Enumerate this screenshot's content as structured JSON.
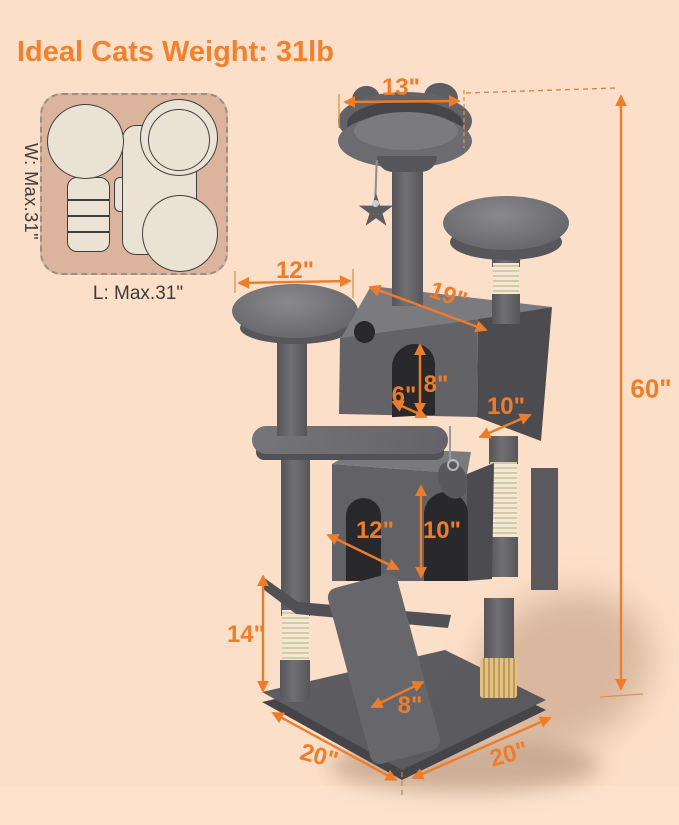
{
  "title": "Ideal Cats Weight: 31lb",
  "footprint_diagram": {
    "width_label": "W: Max.31\"",
    "length_label": "L: Max.31\""
  },
  "dimensions": {
    "top_perch_width": "13\"",
    "left_perch_width": "12\"",
    "upper_condo_width": "19\"",
    "total_height": "60\"",
    "upper_entry_depth": "6\"",
    "upper_entry_height": "8\"",
    "upper_condo_depth": "10\"",
    "lower_condo_width": "12\"",
    "lower_condo_height": "10\"",
    "lower_section_height": "14\"",
    "ramp_width": "8\"",
    "base_depth_left": "20\"",
    "base_width_right": "20\""
  },
  "colors": {
    "background": "#fcdfc8",
    "accent_orange": "#ed7d2b",
    "title_orange": "#f0812f",
    "tree_gray": "#626266",
    "sisal_cream": "#f1e9d1",
    "footprint_tan": "#dcb49d",
    "footprint_cream": "#eae3d3"
  }
}
